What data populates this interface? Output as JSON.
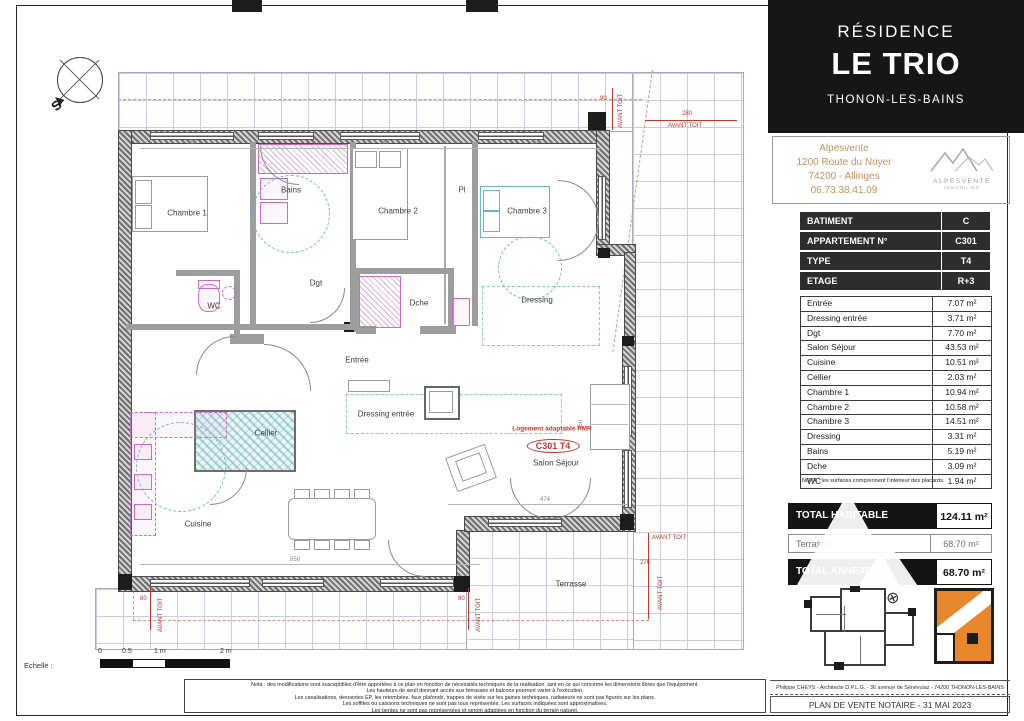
{
  "colors": {
    "brand_black": "#161616",
    "agency_tan": "#bf9264",
    "highlight_orange": "#e8862b",
    "annotation_red": "#c0392b",
    "fixture_pink": "#c56fc0",
    "hatch_teal": "#79b8c0"
  },
  "titleblock": {
    "residence_line": "RÉSIDENCE",
    "name": "LE TRIO",
    "city": "THONON-LES-BAINS",
    "agency": {
      "name": "Alpesvente",
      "street": "1200 Route du Noyer",
      "city": "74200 - Allinges",
      "phone": "06.73.38.41.09",
      "logo_name": "ALPESVENTE",
      "logo_sub": "IMMOBILIER"
    },
    "info": {
      "rows": [
        {
          "label": "BATIMENT",
          "value": "C"
        },
        {
          "label": "APPARTEMENT N°",
          "value": "C301"
        },
        {
          "label": "TYPE",
          "value": "T4"
        },
        {
          "label": "ETAGE",
          "value": "R+3"
        }
      ]
    },
    "surfaces": {
      "rows": [
        {
          "label": "Entrée",
          "value": "7.07 m²"
        },
        {
          "label": "Dressing entrée",
          "value": "3.71 m²"
        },
        {
          "label": "Dgt",
          "value": "7.70 m²"
        },
        {
          "label": "Salon Séjour",
          "value": "43.53 m²"
        },
        {
          "label": "Cuisine",
          "value": "10.51 m²"
        },
        {
          "label": "Cellier",
          "value": "2.03 m²"
        },
        {
          "label": "Chambre 1",
          "value": "10.94 m²"
        },
        {
          "label": "Chambre 2",
          "value": "10.58 m²"
        },
        {
          "label": "Chambre 3",
          "value": "14.51 m²"
        },
        {
          "label": "Dressing",
          "value": "3.31 m²"
        },
        {
          "label": "Bains",
          "value": "5.19 m²"
        },
        {
          "label": "Dche",
          "value": "3.09 m²"
        },
        {
          "label": "WC",
          "value": "1.94 m²"
        }
      ]
    },
    "nota": "NOTA : les surfaces comprennent l'intérieur des placards.",
    "totals": {
      "habitable_label": "TOTAL HABITABLE",
      "habitable_value": "124.11 m²",
      "terrasse_label": "Terrasse",
      "terrasse_value": "68.70 m²",
      "annexes_label": "TOTAL ANNEXES",
      "annexes_value": "68.70 m²"
    },
    "footer": {
      "architect": "Philippe CHEYS - Architecte D.P.L.G. - 36 avenue de Sénévulaz - 74200 THONON-LES-BAINS",
      "doc_title": "PLAN DE VENTE NOTAIRE - 31 MAI 2023"
    }
  },
  "plan": {
    "rooms": {
      "chambre1": "Chambre 1",
      "bains": "Bains",
      "chambre2": "Chambre 2",
      "pl": "Pl",
      "chambre3": "Chambre 3",
      "wc": "WC",
      "dgt": "Dgt",
      "dche": "Dche",
      "dressing": "Dressing",
      "entree": "Entrée",
      "dressing_entree": "Dressing entrée",
      "cellier": "Cellier",
      "cuisine": "Cuisine",
      "salon": "Salon Séjour",
      "terrasse": "Terrasse"
    },
    "unit_tag": "C301 T4",
    "pmr_note": "Logement adaptable PMR",
    "avant_toit": "AVANT TOIT",
    "compass_letter": "S",
    "scale": {
      "label": "Echelle :",
      "t0": "0",
      "t05": "0.5",
      "t1": "1 m",
      "t2": "2 m"
    },
    "dims": {
      "d280": "280",
      "d339": "339",
      "d60": "60",
      "d304": "304",
      "d850": "850",
      "d474": "474",
      "d450": "450",
      "d90": "90",
      "d276": "276",
      "d80": "80"
    }
  },
  "icons": {
    "north_glyph": "⊗"
  },
  "notes": {
    "line1": "Nota : des modifications sont susceptibles d'être apportées à ce plan en fonction de nécessités techniques de la réalisation, tant en ce qui concerne les dimensions libres que l'équipement.",
    "line2": "Les hauteurs de seuil donnant accès aux terrasses et balcons pourront varier à l'exécution.",
    "line3": "Les canalisations, descentes EP, les retombées, faux plafonds, trappes de visite sur les gaines techniques, radiateurs ne sont pas figurés sur les plans.",
    "line4": "Les soffites ou caissons techniques ne sont pas tous représentés. Les surfaces indiquées sont approximatives.",
    "line5": "Les pentes ne sont pas représentées et seront adaptées en fonction du terrain naturel."
  }
}
